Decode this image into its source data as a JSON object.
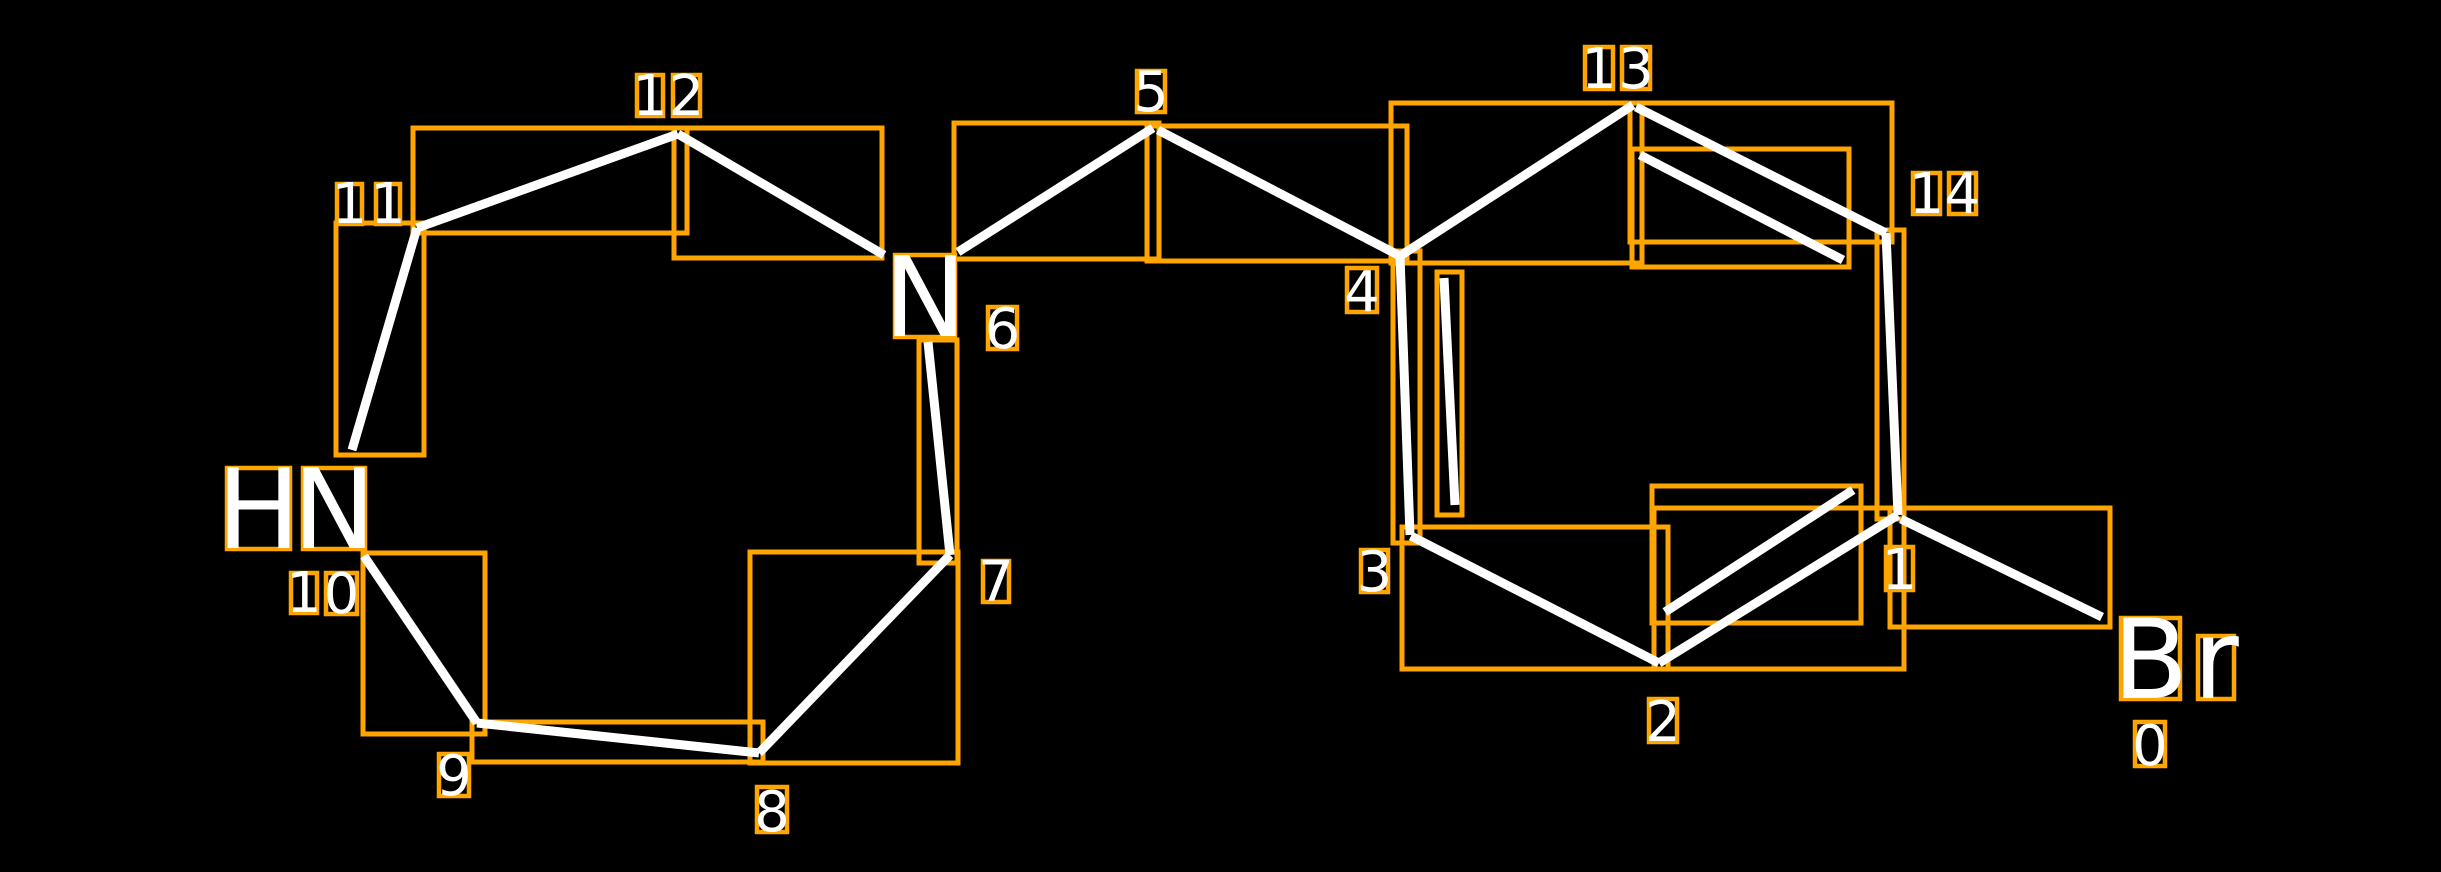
{
  "scene": {
    "width": 2441,
    "height": 872,
    "background": "#000000"
  },
  "style": {
    "bond_color": "#ffffff",
    "bond_width": 9,
    "box_color": "#ffa500",
    "bond_box_stroke": 5,
    "label_box_stroke": 4.5,
    "text_color": "#ffffff",
    "index_font_size": 56,
    "element_font_size": 111
  },
  "molecule": {
    "kind": "annotated 2D chemical structure",
    "heteroatom_labels": [
      "Br",
      "N",
      "HN"
    ],
    "atom_indices_shown": [
      "0",
      "1",
      "2",
      "3",
      "4",
      "5",
      "6",
      "7",
      "8",
      "9",
      "10",
      "11",
      "12",
      "13",
      "14"
    ]
  },
  "bonds": [
    {
      "atoms": "11-12",
      "order": 1,
      "line": [
        417,
        228,
        678,
        134
      ],
      "box": [
        413,
        128,
        274,
        105
      ]
    },
    {
      "atoms": "12-6",
      "order": 1,
      "line": [
        678,
        134,
        884,
        255
      ],
      "box": [
        674,
        128,
        208,
        130
      ]
    },
    {
      "atoms": "6-5",
      "order": 1,
      "line": [
        958,
        252,
        1153,
        128
      ],
      "box": [
        954,
        123,
        205,
        136
      ]
    },
    {
      "atoms": "5-4",
      "order": 1,
      "line": [
        1158,
        130,
        1400,
        256
      ],
      "box": [
        1147,
        126,
        260,
        135
      ]
    },
    {
      "atoms": "4-13",
      "order": 1,
      "line": [
        1400,
        256,
        1633,
        105
      ],
      "box": [
        1391,
        103,
        251,
        160
      ]
    },
    {
      "atoms": "13-14",
      "order": 2,
      "line": [
        1636,
        107,
        1886,
        233
      ],
      "box": [
        1630,
        103,
        262,
        139
      ]
    },
    {
      "atoms": "13-14-inner",
      "order": 2,
      "line": [
        1640,
        155,
        1843,
        260
      ],
      "box": [
        1632,
        149,
        217,
        118
      ]
    },
    {
      "atoms": "14-1",
      "order": 1,
      "line": [
        1886,
        233,
        1898,
        515
      ],
      "box": [
        1877,
        230,
        27,
        289
      ]
    },
    {
      "atoms": "1-0",
      "order": 1,
      "line": [
        1901,
        519,
        2102,
        617
      ],
      "box": [
        1890,
        508,
        220,
        119
      ]
    },
    {
      "atoms": "1-2",
      "order": 2,
      "line": [
        1898,
        515,
        1659,
        663
      ],
      "box": [
        1654,
        508,
        250,
        161
      ]
    },
    {
      "atoms": "1-2-inner",
      "order": 2,
      "line": [
        1853,
        490,
        1665,
        612
      ],
      "box": [
        1652,
        486,
        209,
        137
      ]
    },
    {
      "atoms": "2-3",
      "order": 1,
      "line": [
        1659,
        663,
        1411,
        536
      ],
      "box": [
        1402,
        527,
        266,
        142
      ]
    },
    {
      "atoms": "3-4",
      "order": 2,
      "line": [
        1410,
        535,
        1400,
        256
      ],
      "box": [
        1393,
        251,
        27,
        292
      ]
    },
    {
      "atoms": "3-4-inner",
      "order": 2,
      "line": [
        1444,
        278,
        1455,
        505
      ],
      "box": [
        1437,
        272,
        25,
        243
      ]
    },
    {
      "atoms": "6-7",
      "order": 1,
      "line": [
        928,
        342,
        950,
        555
      ],
      "box": [
        919,
        340,
        38,
        223
      ]
    },
    {
      "atoms": "7-8",
      "order": 1,
      "line": [
        950,
        555,
        759,
        753
      ],
      "box": [
        750,
        552,
        208,
        211
      ]
    },
    {
      "atoms": "8-9",
      "order": 1,
      "line": [
        759,
        753,
        477,
        723
      ],
      "box": [
        472,
        722,
        291,
        40
      ]
    },
    {
      "atoms": "9-10",
      "order": 1,
      "line": [
        477,
        723,
        364,
        556
      ],
      "box": [
        363,
        553,
        122,
        181
      ]
    },
    {
      "atoms": "10-11",
      "order": 1,
      "line": [
        352,
        450,
        417,
        228
      ],
      "box": [
        336,
        223,
        88,
        232
      ]
    }
  ],
  "labels": [
    {
      "text": "0",
      "kind": "index",
      "chars": [
        {
          "c": "0",
          "box": [
            2135,
            722,
            30,
            44
          ]
        }
      ]
    },
    {
      "text": "1",
      "kind": "index",
      "chars": [
        {
          "c": "1",
          "box": [
            1886,
            547,
            27,
            43
          ]
        }
      ]
    },
    {
      "text": "2",
      "kind": "index",
      "chars": [
        {
          "c": "2",
          "box": [
            1649,
            699,
            28,
            43
          ]
        }
      ]
    },
    {
      "text": "3",
      "kind": "index",
      "chars": [
        {
          "c": "3",
          "box": [
            1361,
            550,
            27,
            42
          ]
        }
      ]
    },
    {
      "text": "4",
      "kind": "index",
      "chars": [
        {
          "c": "4",
          "box": [
            1347,
            268,
            30,
            44
          ]
        }
      ]
    },
    {
      "text": "5",
      "kind": "index",
      "chars": [
        {
          "c": "5",
          "box": [
            1137,
            71,
            28,
            41
          ]
        }
      ]
    },
    {
      "text": "6",
      "kind": "index",
      "chars": [
        {
          "c": "6",
          "box": [
            988,
            307,
            29,
            42
          ]
        }
      ]
    },
    {
      "text": "7",
      "kind": "index",
      "chars": [
        {
          "c": "7",
          "box": [
            983,
            561,
            26,
            41
          ]
        }
      ]
    },
    {
      "text": "8",
      "kind": "index",
      "chars": [
        {
          "c": "8",
          "box": [
            757,
            787,
            30,
            45
          ]
        }
      ]
    },
    {
      "text": "9",
      "kind": "index",
      "chars": [
        {
          "c": "9",
          "box": [
            439,
            754,
            30,
            42
          ]
        }
      ]
    },
    {
      "text": "10",
      "kind": "index",
      "chars": [
        {
          "c": "1",
          "box": [
            291,
            573,
            26,
            40
          ]
        },
        {
          "c": "0",
          "box": [
            326,
            573,
            31,
            41
          ]
        }
      ]
    },
    {
      "text": "11",
      "kind": "index",
      "chars": [
        {
          "c": "1",
          "box": [
            337,
            184,
            25,
            40
          ]
        },
        {
          "c": "1",
          "box": [
            376,
            184,
            24,
            40
          ]
        }
      ]
    },
    {
      "text": "12",
      "kind": "index",
      "chars": [
        {
          "c": "1",
          "box": [
            637,
            75,
            26,
            41
          ]
        },
        {
          "c": "2",
          "box": [
            673,
            75,
            27,
            41
          ]
        }
      ]
    },
    {
      "text": "13",
      "kind": "index",
      "chars": [
        {
          "c": "1",
          "box": [
            1585,
            47,
            28,
            42
          ]
        },
        {
          "c": "3",
          "box": [
            1622,
            47,
            28,
            42
          ]
        }
      ]
    },
    {
      "text": "14",
      "kind": "index",
      "chars": [
        {
          "c": "1",
          "box": [
            1913,
            173,
            27,
            41
          ]
        },
        {
          "c": "4",
          "box": [
            1949,
            173,
            27,
            41
          ]
        }
      ]
    },
    {
      "text": "HN",
      "kind": "element",
      "chars": [
        {
          "c": "H",
          "box": [
            227,
            468,
            63,
            81
          ]
        },
        {
          "c": "N",
          "box": [
            303,
            468,
            62,
            81
          ]
        }
      ]
    },
    {
      "text": "N",
      "kind": "element",
      "chars": [
        {
          "c": "N",
          "box": [
            895,
            255,
            60,
            82
          ]
        }
      ]
    },
    {
      "text": "Br",
      "kind": "element",
      "chars": [
        {
          "c": "B",
          "box": [
            2121,
            618,
            59,
            81
          ]
        },
        {
          "c": "r",
          "box": [
            2198,
            636,
            36,
            63
          ]
        }
      ]
    }
  ]
}
